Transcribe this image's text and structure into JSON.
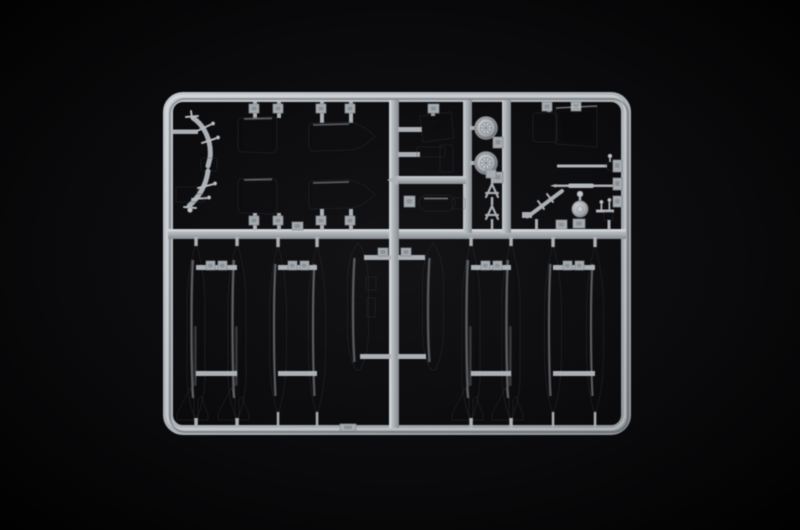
{
  "meta": {
    "description": "Product photo of a light gray injection-molded plastic model kit sprue (parts tree) with rounded rectangular runner frame, photographed on a black background"
  },
  "colors": {
    "background": "#050506",
    "vignette": "#16161a",
    "plastic_base": "#aab0b5",
    "plastic_highlight": "#d3d7db",
    "plastic_mid": "#9aa0a5",
    "plastic_shadow": "#7b8085",
    "plastic_deep": "#55595d"
  },
  "sprue": {
    "frame": {
      "shape": "rounded rectangle runner",
      "material": "light gray polystyrene"
    },
    "layout": {
      "top_section": "detail parts: landing gear struts, engine cowling and nacelle halves, hatch plate, brackets, pod, two spoked main wheels, antenna frames, crew seat, pitot rods, boarding ladder, tail wheel, valve",
      "bottom_section": "ten external drop tank halves in a row, joined by cross runners"
    },
    "parts": [
      {
        "name": "landing-gear-strut",
        "count": 2
      },
      {
        "name": "landing-gear-bracket",
        "count": 1
      },
      {
        "name": "engine-cowling-front-half",
        "count": 2
      },
      {
        "name": "engine-nacelle-rear-half",
        "count": 2
      },
      {
        "name": "access-hatch-plate",
        "count": 1
      },
      {
        "name": "equipment-bracket",
        "count": 1
      },
      {
        "name": "cylindrical-pod",
        "count": 1
      },
      {
        "name": "main-wheel",
        "count": 2
      },
      {
        "name": "antenna-a-frame",
        "count": 2
      },
      {
        "name": "crew-seat",
        "count": 1
      },
      {
        "name": "pitot-rod",
        "count": 2
      },
      {
        "name": "boarding-ladder",
        "count": 1
      },
      {
        "name": "tail-wheel",
        "count": 1
      },
      {
        "name": "fuel-valve",
        "count": 1
      },
      {
        "name": "drop-tank-finned-half",
        "count": 4
      },
      {
        "name": "drop-tank-slender-half",
        "count": 4
      },
      {
        "name": "drop-tank-wide-half",
        "count": 2
      },
      {
        "name": "sprue-gate-tab",
        "count": 30
      }
    ]
  }
}
